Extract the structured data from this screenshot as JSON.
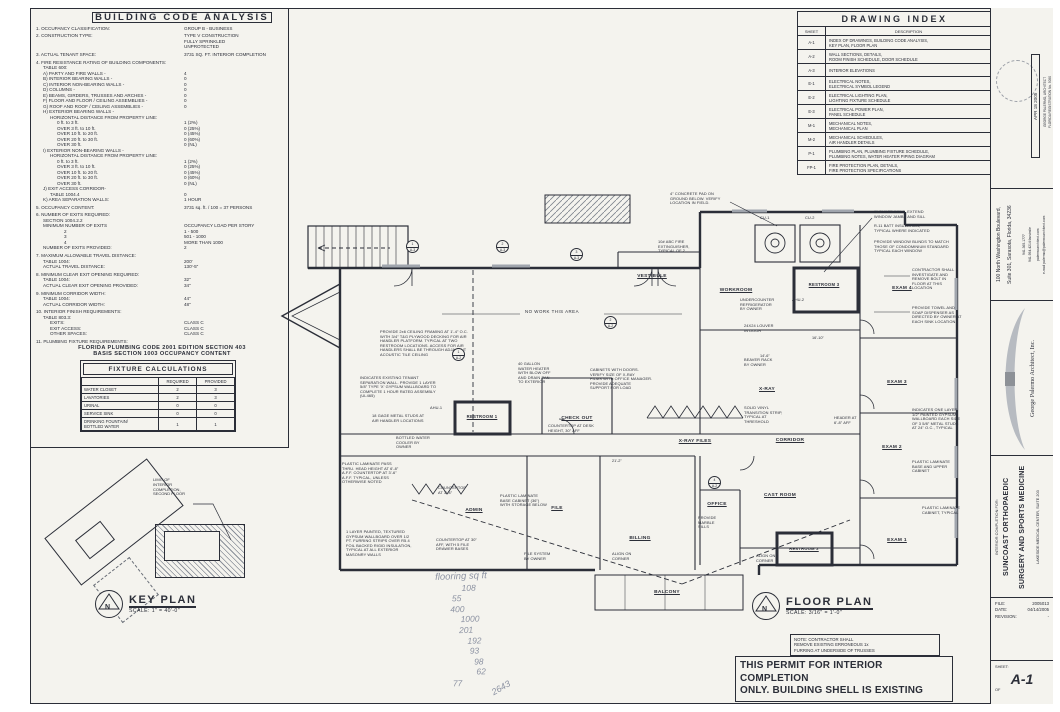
{
  "accent_ink": "#2b2e38",
  "paper_color": "#f4f3ee",
  "pencil_color": "#8d93a3",
  "building_code_analysis": {
    "title": "BUILDING CODE ANALYSIS",
    "items": [
      {
        "label": "1. OCCUPANCY CLASSIFICATION:",
        "value": "GROUP B - BUSINESS",
        "indent": 0,
        "gap": true
      },
      {
        "label": "2. CONSTRUCTION TYPE:",
        "value": "TYPE V CONSTRUCTION",
        "indent": 0,
        "gap": true
      },
      {
        "label": "",
        "value": "FULLY SPRINKLED",
        "indent": 0
      },
      {
        "label": "",
        "value": "UNPROTECTED",
        "indent": 0
      },
      {
        "label": "3. ACTUAL TENANT SPACE:",
        "value": "3731 SQ. FT. INTERIOR COMPLETION",
        "indent": 0,
        "gap": true
      },
      {
        "label": "4. FIRE RESISTANCE RATING OF BUILDING COMPONENTS:",
        "value": "",
        "indent": 0,
        "gap": true
      },
      {
        "label": "TABLE 600:",
        "value": "",
        "indent": 1
      },
      {
        "label": "A) PARTY AND FIRE WALLS -",
        "value": "4",
        "indent": 1
      },
      {
        "label": "B) INTERIOR BEARING WALLS -",
        "value": "0",
        "indent": 1
      },
      {
        "label": "C) INTERIOR NON-BEARING WALLS -",
        "value": "0",
        "indent": 1
      },
      {
        "label": "D) COLUMNS -",
        "value": "0",
        "indent": 1
      },
      {
        "label": "E) BEAMS, GIRDERS, TRUSSES AND ARCHES -",
        "value": "0",
        "indent": 1
      },
      {
        "label": "F) FLOOR AND FLOOR / CEILING ASSEMBLIES -",
        "value": "0",
        "indent": 1
      },
      {
        "label": "G) ROOF AND ROOF / CEILING ASSEMBLIES -",
        "value": "0",
        "indent": 1
      },
      {
        "label": "H) EXTERIOR BEARING WALLS -",
        "value": "",
        "indent": 1
      },
      {
        "label": "HORIZONTAL DISTANCE FROM PROPERTY LINE:",
        "value": "",
        "indent": 2
      },
      {
        "label": "0 ft. to 3 ft.",
        "value": "1 (2%)",
        "indent": 3
      },
      {
        "label": "OVER 3 ft. to 10 ft.",
        "value": "0 (25%)",
        "indent": 3
      },
      {
        "label": "OVER 10 ft. to 20 ft.",
        "value": "0 (45%)",
        "indent": 3
      },
      {
        "label": "OVER 20 ft. to 30 ft.",
        "value": "0 (60%)",
        "indent": 3
      },
      {
        "label": "OVER 30 ft.",
        "value": "0 (NL)",
        "indent": 3
      },
      {
        "label": "I) EXTERIOR NON-BEARING WALLS -",
        "value": "",
        "indent": 1
      },
      {
        "label": "HORIZONTAL DISTANCE FROM PROPERTY LINE:",
        "value": "",
        "indent": 2
      },
      {
        "label": "0 ft. to 3 ft.",
        "value": "1 (2%)",
        "indent": 3
      },
      {
        "label": "OVER 3 ft. to 10 ft.",
        "value": "0 (25%)",
        "indent": 3
      },
      {
        "label": "OVER 10 ft. to 20 ft.",
        "value": "0 (45%)",
        "indent": 3
      },
      {
        "label": "OVER 20 ft. to 30 ft.",
        "value": "0 (60%)",
        "indent": 3
      },
      {
        "label": "OVER 30 ft.",
        "value": "0 (NL)",
        "indent": 3
      },
      {
        "label": "J) EXIT ACCESS CORRIDOR-",
        "value": "",
        "indent": 1
      },
      {
        "label": "TABLE 1004.4",
        "value": "0",
        "indent": 2
      },
      {
        "label": "K) AREA SEPARATION WALLS:",
        "value": "1 HOUR",
        "indent": 1
      },
      {
        "label": "5. OCCUPANCY CONTENT:",
        "value": "3731 sq. ft. / 100 = 37 PERSONS",
        "indent": 0,
        "gap": true
      },
      {
        "label": "6. NUMBER OF EXITS REQUIRED:",
        "value": "",
        "indent": 0,
        "gap": true
      },
      {
        "label": "SECTION 1004.2.2",
        "value": "",
        "indent": 1
      },
      {
        "label": "MINIMUM NUMBER OF EXITS",
        "value": "OCCUPANCY LOAD PER STORY",
        "indent": 1
      },
      {
        "label": "2",
        "value": "1 - 500",
        "indent": 4
      },
      {
        "label": "3",
        "value": "501 - 1000",
        "indent": 4
      },
      {
        "label": "4",
        "value": "MORE THAN 1000",
        "indent": 4
      },
      {
        "label": "NUMBER OF EXITS PROVIDED:",
        "value": "2",
        "indent": 1
      },
      {
        "label": "7. MAXIMUM ALLOWABLE TRAVEL DISTANCE:",
        "value": "",
        "indent": 0,
        "gap": true
      },
      {
        "label": "TABLE 1004:",
        "value": "200'",
        "indent": 1
      },
      {
        "label": "ACTUAL TRAVEL DISTANCE:",
        "value": "130'-5\"",
        "indent": 1
      },
      {
        "label": "8. MINIMUM CLEAR EXIT OPENING REQUIRED:",
        "value": "",
        "indent": 0,
        "gap": true
      },
      {
        "label": "TABLE 1004:",
        "value": "32\"",
        "indent": 1
      },
      {
        "label": "ACTUAL CLEAR EXIT OPENING PROVIDED:",
        "value": "34\"",
        "indent": 1
      },
      {
        "label": "9. MINIMUM CORRIDOR WIDTH:",
        "value": "",
        "indent": 0,
        "gap": true
      },
      {
        "label": "TABLE 1004:",
        "value": "44\"",
        "indent": 1
      },
      {
        "label": "ACTUAL CORRIDOR WIDTH:",
        "value": "48\"",
        "indent": 1
      },
      {
        "label": "10. INTERIOR FINISH REQUIREMENTS:",
        "value": "",
        "indent": 0,
        "gap": true
      },
      {
        "label": "TABLE 803.3:",
        "value": "",
        "indent": 1
      },
      {
        "label": "EXITS:",
        "value": "CLASS C",
        "indent": 2
      },
      {
        "label": "EXIT ACCESS:",
        "value": "CLASS C",
        "indent": 2
      },
      {
        "label": "OTHER SPACES:",
        "value": "CLASS C",
        "indent": 2
      },
      {
        "label": "11. PLUMBING FIXTURE REQUIREMENTS:",
        "value": "",
        "indent": 0,
        "gap": true
      }
    ],
    "footer1": "FLORIDA PLUMBING CODE 2001 EDITION SECTION 403",
    "footer2": "BASIS SECTION 1003 OCCUPANCY  CONTENT"
  },
  "fixture_calculations": {
    "title": "FIXTURE CALCULATIONS",
    "required_label": "REQUIRED",
    "provided_label": "PROVIDED",
    "rows": [
      {
        "name": "WATER CLOSET",
        "req": "2",
        "prov": "3"
      },
      {
        "name": "LAVATORIES",
        "req": "2",
        "prov": "3"
      },
      {
        "name": "URINAL",
        "req": "0",
        "prov": "0"
      },
      {
        "name": "SERVICE SINK",
        "req": "0",
        "prov": "0"
      },
      {
        "name": "DRINKING FOUNTAIN/\nBOTTLED WATER",
        "req": "1",
        "prov": "1"
      }
    ]
  },
  "drawing_index": {
    "title": "DRAWING INDEX",
    "sheet_label": "SHEET",
    "description_label": "DESCRIPTION",
    "rows": [
      {
        "sheet": "A-1",
        "desc": "INDEX OF DRAWINGS, BUILDING CODE ANALYSIS,\nKEY PLAN, FLOOR PLAN"
      },
      {
        "sheet": "A-2",
        "desc": "WALL SECTIONS, DETAILS,\nROOM FINISH SCHEDULE, DOOR SCHEDULE"
      },
      {
        "sheet": "A-3",
        "desc": "INTERIOR ELEVATIONS"
      },
      {
        "sheet": "E-1",
        "desc": "ELECTRICAL NOTES,\nELECTRICAL SYMBOL LEGEND"
      },
      {
        "sheet": "E-2",
        "desc": "ELECTRICAL LIGHTING PLAN,\nLIGHTING FIXTURE SCHEDULE"
      },
      {
        "sheet": "E-3",
        "desc": "ELECTRICAL POWER PLAN,\nPANEL SCHEDULE"
      },
      {
        "sheet": "M-1",
        "desc": "MECHANICAL NOTES,\nMECHANICAL PLAN"
      },
      {
        "sheet": "M-2",
        "desc": "MECHANICAL SCHEDULES,\nAIR HANDLER DETAILS"
      },
      {
        "sheet": "P-1",
        "desc": "PLUMBING PLAN, PLUMBING FIXTURE SCHEDULE,\nPLUMBING NOTES, WATER HEATER PIPING DIAGRAM"
      },
      {
        "sheet": "FP-1",
        "desc": "FIRE PROTECTION PLAN, DETAILS,\nFIRE PROTECTION SPECIFICATIONS"
      }
    ]
  },
  "floor_plan": {
    "rooms": {
      "vestibule": "VESTIBULE",
      "workroom": "WORKROOM",
      "restroom3": "RESTROOM 3",
      "exam4": "EXAM 4",
      "restroom1": "RESTROOM 1",
      "checkout": "CHECK OUT",
      "xray_files": "X-RAY FILES",
      "xray": "X-RAY",
      "corridor": "CORRIDOR",
      "cast_room": "CAST ROOM",
      "exam3": "EXAM 3",
      "exam2": "EXAM 2",
      "exam1": "EXAM 1",
      "office": "OFFICE",
      "restroom2": "RESTROOM 2",
      "admin": "ADMIN",
      "file": "FILE",
      "billing": "BILLING",
      "balcony": "BALCONY"
    },
    "no_work": "NO WORK THIS AREA",
    "annotations": {
      "concrete_pad": "4\" CONCRETE PAD ON\nGROUND BELOW. VERIFY\nLOCATION IN FIELD.",
      "cu1": "CU-1",
      "cu2": "CU-2",
      "fire_ext": "10# ABC FIRE\nEXTINGUISHER,\nTYPICAL OF 2",
      "chase_wall": "6\" CHASE WALL, EXTEND\nWINDOW JAMBS AND SILL",
      "batt_insulation": "R-11 BATT INSULATION,\nTYPICAL WHERE INDICATED",
      "window_blinds": "PROVIDE WINDOW BLINDS TO MATCH\nTHOSE OF CONDOMINIUM STANDARD\nTYPICAL EACH WINDOW",
      "remove_bolt": "CONTRACTOR SHALL\nINVESTIGATE AND\nREMOVE BOLT IN\nFLOOR AT THIS LOCATION",
      "towel_soap": "PROVIDE TOWEL AND\nSOAP DISPENSER AS\nDIRECTED BY OWNER AT\nEACH SINK LOCATION.",
      "wall_type": "INDICATES ONE LAYER\n1/2\" PAINTED GYPSUM\nWALLBOARD EACH SIDE\nOF 3 5/8\" METAL STUDS\nAT 24\" O.C., TYPICAL",
      "pl_base_upper": "PLASTIC LAMINATE\nBASE AND UPPER\nCABINET",
      "pl_cabinet": "PLASTIC LAMINATE\nCABINET, TYPICAL",
      "ceiling_framing": "PROVIDE 2x6 CEILING FRAMING AT 1'-4\" O.C.\nWITH 3/4\" T&G PLYWOOD DECKING FOR AIR\nHANDLER PLATFORM.  TYPICAL AT TWO\nRESTROOM LOCATIONS.  ACCESS FOR AIR\nHANDLERS SHALL BE THROUGH ADJACENT\nACOUSTIC TILE CEILING",
      "tenant_separation": "INDICATES EXISTING TENANT\nSEPARATION WALL.  PROVIDE 1 LAYER\n5/8\" TYPE 'X' GYPSUM WALLBOARD TO\nCOMPLETE 1 HOUR RATED ASSEMBLY\n(UL465)",
      "metal_studs": "18 GAGE METAL STUDS AT\nAIR HANDLER LOCATIONS",
      "water_cooler": "BOTTLED WATER\nCOOLER BY\nOWNER",
      "pass_thru": "PLASTIC LAMINATE PASS\nTHRU. HEAD HEIGHT AT 6'-8\"\nA.F.F. COUNTERTOP AT 3'-6\"\nA.F.F. TYPICAL, UNLESS\nOTHERWISE NOTED",
      "water_heater": "40 GALLON\nWATER HEATER\nWITH BLOW OFF\nAND DRAIN PAN\nTO EXTERIOR",
      "xray_cabinets": "CABINETS WITH DOORS.\nVERIFY SIZE OF X-RAY\nFILMS WITH OFFICE MANAGER.\nPROVIDE ADEQUATE\nSUPPORT FOR LOAD",
      "countertop_desk": "COUNTERTOP AT DESK\nHEIGHT, 30\" AFF",
      "undercounter_fridge": "UNDERCOUNTER\nREFRIGERATOR\nBY OWNER",
      "louver": "24X24 LOUVER\nIN DOOR",
      "beaver_rack": "BEAVER RACK\nBY OWNER",
      "vinyl_strip": "SOLID VINYL\nTRANSITION STRIP,\nTYPICAL AT\nTHRESHOLD",
      "header_aff": "HEADER AT\n6'-8\" AFF",
      "marble_sills": "PROVIDE\nMARBLE\nSILLS",
      "countertop_admin": "COUNTERTOP\nAT 3'-4\"",
      "pl_base_cabinet": "PLASTIC LAMINATE\nBASE CABINET (36\")\nWITH STORAGE BELOW",
      "countertop_file": "COUNTERTOP AT 30\"\nAFF, WITH 5 FILE\nDRAWER BASES",
      "file_system": "FILE SYSTEM\nBY OWNER",
      "align_corner1": "ALIGN ON\nCORNER",
      "align_corner2": "ALIGN ON\nCORNER",
      "masonry_walls": "1 LAYER PAINTED, TEXTURED\nGYPSUM WALLBOARD OVER 1/2\nPT. FURRING STRIPS OVER R5.4\nFOIL BACKED RIGID INSULATION,\nTYPICAL AT ALL EXTERIOR\nMASONRY WALLS",
      "ahu1": "AHU-1",
      "ahu2": "AHU-2"
    },
    "dims": {
      "d1": "21'-2\"",
      "d2": "14'-6\"",
      "d3": "16'-10\""
    },
    "markers": [
      {
        "num": "1",
        "sheet": "A-3"
      },
      {
        "num": "2",
        "sheet": "A-3"
      },
      {
        "num": "3",
        "sheet": "A-3"
      },
      {
        "num": "1",
        "sheet": "A-2"
      },
      {
        "num": "2",
        "sheet": "A-2"
      },
      {
        "num": "4",
        "sheet": "A-2"
      }
    ]
  },
  "handwritten": {
    "title": "flooring sq ft",
    "values": [
      "108",
      "55",
      "400",
      "1000",
      "201",
      "192",
      "93",
      "98",
      "62",
      "77"
    ],
    "total": "2643"
  },
  "key_plan": {
    "title": "KEY PLAN",
    "scale": "SCALE: 1\" = 40'-0\"",
    "north": "N",
    "limit_note": "LIMIT OF\nINTERIOR\nCOMPLETION,\nSECOND FLOOR"
  },
  "floor_plan_title": {
    "title": "FLOOR PLAN",
    "scale": "SCALE: 3/16\" = 1'-0\"",
    "north": "N",
    "note": "NOTE:  CONTRACTOR SHALL\nREMOVE EXISTING ERRONEOUS 1x\nFURRING AT UNDERSIDE OF TRUSSES",
    "permit_line1": "THIS PERMIT FOR INTERIOR COMPLETION",
    "permit_line2": "ONLY. BUILDING SHELL IS EXISTING"
  },
  "title_block": {
    "stamp_date": "APR 18 2005",
    "registration1": "GEORGE PALERMO, ARCHITECT",
    "registration2": "FLORIDA REGISTRATION No. 5090",
    "address1": "100 North Washington Boulevard,",
    "address2": "Suite 301, Sarasota, Florida, 34236",
    "phone": "941.365.1777",
    "fax": "941.954.4214 facsimile",
    "web": "palermoarchitect.com",
    "email": "e-mail  palermo@palermoarchitect.com",
    "firm": "George Palermo Architect, Inc.",
    "project_prefix": "INTERIOR COMPLETION FOR:",
    "project_name1": "SUNCOAST ORTHOPAEDIC",
    "project_name2": "SURGERY AND SPORTS MEDICINE",
    "project_addr": "LAKESIDE MEDICAL CENTER, SUITE 203",
    "file_label": "FILE:",
    "file_value": "2005013",
    "date_label": "DATE:",
    "date_value": "04/14/2005",
    "revision_label": "REVISION:",
    "revision_value": "-",
    "sheet_label": "SHEET:",
    "sheet_value": "A-1",
    "of_label": "OF"
  }
}
